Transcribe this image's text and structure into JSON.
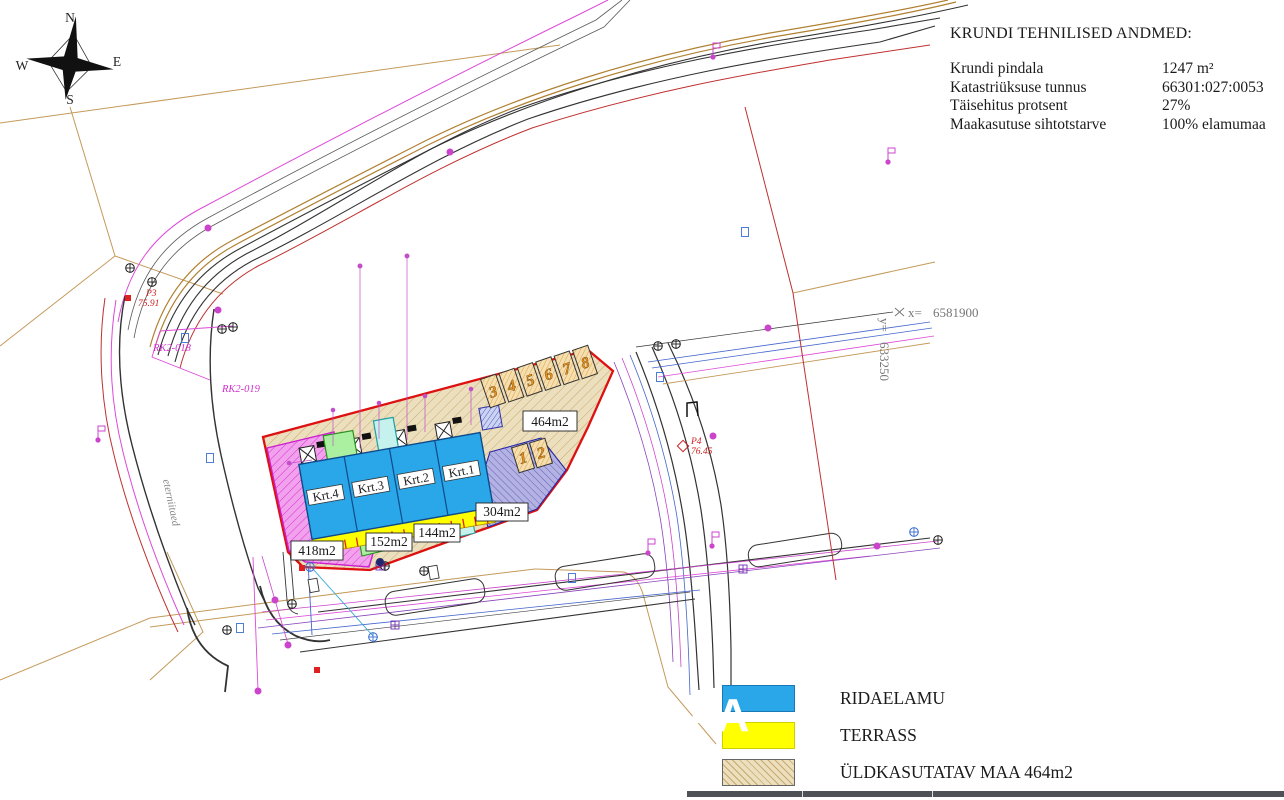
{
  "title_block": {
    "heading": "KRUNDI TEHNILISED ANDMED:",
    "rows": [
      {
        "label": "Krundi pindala",
        "value": "1247 m²"
      },
      {
        "label": "Katastriüksuse tunnus",
        "value": "66301:027:0053"
      },
      {
        "label": "Täisehitus protsent",
        "value": "27%"
      },
      {
        "label": "Maakasutuse sihtotstarve",
        "value": "100% elamumaa"
      }
    ]
  },
  "legend": {
    "items": [
      {
        "label": "RIDAELAMU",
        "swatch": "blue"
      },
      {
        "label": "TERRASS",
        "swatch": "yellow"
      },
      {
        "label": "ÜLDKASUTATAV MAA 464m2",
        "swatch": "tan-hatch"
      }
    ]
  },
  "compass": {
    "north": "N",
    "east": "E",
    "south": "S",
    "west": "W"
  },
  "site": {
    "units": [
      "Krt.1",
      "Krt.2",
      "Krt.3",
      "Krt.4"
    ],
    "areas": [
      "418m2",
      "152m2",
      "144m2",
      "304m2",
      "464m2"
    ],
    "parking": [
      "1",
      "2",
      "3",
      "4",
      "5",
      "6",
      "7",
      "8"
    ]
  },
  "survey": {
    "coord_x_label": "x=",
    "coord_x_value": "6581900",
    "coord_y_label": "y=",
    "coord_y_value": "633250",
    "point_p3": "P3",
    "point_p3_elev": "75.91",
    "point_p4": "P4",
    "point_p4_elev": "76.45",
    "mark_rk2_018": "RK2-018",
    "mark_rk2_019": "RK2-019",
    "road_name": "eterniitaed"
  },
  "watermark": "AA",
  "colors": {
    "building_blue": "#2aa7e9",
    "terrace_yellow": "#ffff00",
    "common_land_tan": "#ecdfbd",
    "boundary_red": "#dd1111",
    "paved_pink": "#f2a2ec",
    "parking_purple": "#b4b2e2"
  }
}
